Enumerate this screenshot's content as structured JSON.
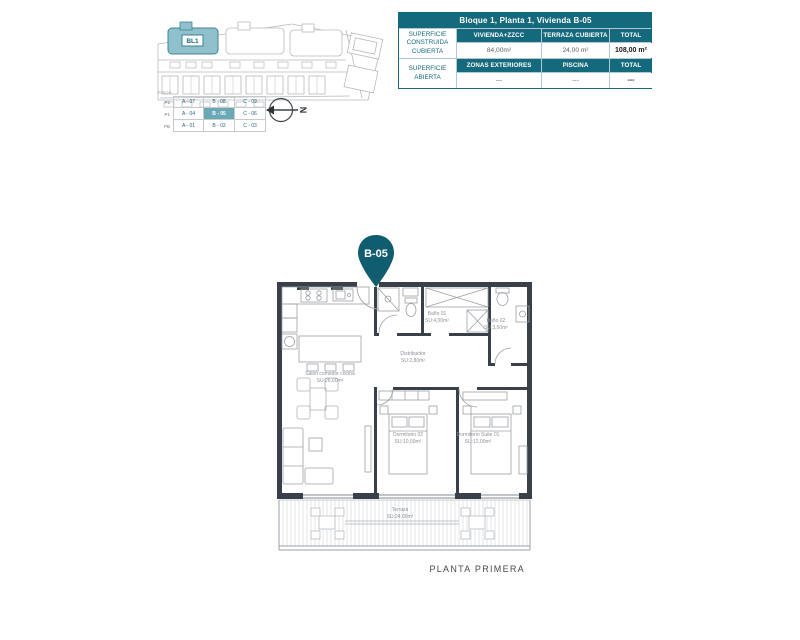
{
  "colors": {
    "teal": "#15697d",
    "teal_dark": "#0f5d6e",
    "teal_light": "#8fc0cb",
    "wall": "#3a4049",
    "line_gray": "#9ba0a6"
  },
  "site_plan": {
    "block_label": "BL1",
    "compass_label": "N"
  },
  "key_table": {
    "title": "PISOS",
    "floors": [
      "P2",
      "P1",
      "PB"
    ],
    "rows": [
      [
        "A - 07",
        "B - 08",
        "C - 09"
      ],
      [
        "A - 04",
        "B - 05",
        "C - 06"
      ],
      [
        "A - 01",
        "B - 02",
        "C - 03"
      ]
    ],
    "highlighted_cell": "B - 05"
  },
  "info_table": {
    "title": "Bloque 1, Planta 1, Vivienda B-05",
    "groups": [
      {
        "label_lines": [
          "SUPERFICIE",
          "CONSTRUIDA",
          "CUBIERTA"
        ],
        "headers": [
          "VIVIENDA+ZZCC",
          "TERRAZA CUBIERTA",
          "TOTAL"
        ],
        "values": [
          "84,00m²",
          "24,00 m²",
          "108,00 m²"
        ]
      },
      {
        "label_lines": [
          "SUPERFICIE",
          "ABIERTA",
          ""
        ],
        "headers": [
          "ZONAS EXTERIORES",
          "PISCINA",
          "TOTAL"
        ],
        "values": [
          "---",
          "---",
          "---"
        ]
      }
    ]
  },
  "unit_pin": {
    "label": "B-05"
  },
  "floor_plan": {
    "caption": "PLANTA PRIMERA",
    "rooms": [
      {
        "name": "Salón comedor cocina",
        "area": "SU:26,00m²"
      },
      {
        "name": "Baño 01",
        "area": "SU:4,00m²"
      },
      {
        "name": "Baño 02",
        "area": "SU:3,50m²"
      },
      {
        "name": "Distribuidor",
        "area": "SU:2,80m²"
      },
      {
        "name": "Dormitorio 02",
        "area": "SU:10,00m²"
      },
      {
        "name": "Dormitorio Suite 01",
        "area": "SU:12,00m²"
      },
      {
        "name": "Terraza",
        "area": "SU:24,00m²"
      }
    ]
  }
}
